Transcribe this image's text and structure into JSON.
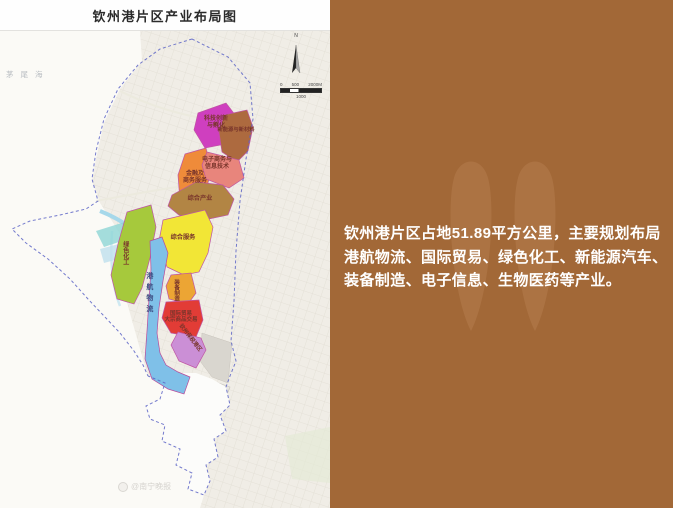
{
  "window": {
    "title": "钦州港片区产业布局图"
  },
  "colors": {
    "panel-bg": "#a26837",
    "panel-text": "#ffffff",
    "panel-watermark": "#c08a5c",
    "map-label": "#79352b",
    "river-label": "#3d4e83",
    "boundary-dash": "#5b63c5"
  },
  "map": {
    "sea_label": "茅尾海",
    "compass_label": "N",
    "scale": {
      "start": "0",
      "mid_top": "500",
      "end": "2000M",
      "mid_bottom": "1000"
    },
    "zones": [
      {
        "name": "科技创新与孵化",
        "color": "#cf3fbf",
        "label_lines": [
          "科技创新",
          "与孵化"
        ]
      },
      {
        "name": "新能源与新材料",
        "color": "#ad6a3f"
      },
      {
        "name": "金融及商务服务",
        "color": "#ef8b3a",
        "label_lines": [
          "金融及",
          "商务服务"
        ]
      },
      {
        "name": "电子商务与信息技术",
        "color": "#e8857c",
        "label_lines": [
          "电子商务与",
          "信息技术"
        ]
      },
      {
        "name": "综合产业",
        "color": "#b28544"
      },
      {
        "name": "综合服务",
        "color": "#f2e636"
      },
      {
        "name": "绿色化工",
        "color": "#a6c93c"
      },
      {
        "name": "港航物流",
        "color": "#7fc0e8"
      },
      {
        "name": "装备制造",
        "color": "#eca534"
      },
      {
        "name": "国际贸易 大宗商品交易",
        "color": "#e23c36",
        "label_lines": [
          "国际贸易",
          "大宗商品交易"
        ]
      },
      {
        "name": "钦州保税港区",
        "color": "#cb8fd6"
      }
    ],
    "watermark": "@南宁晚报"
  },
  "panel": {
    "lines": [
      "钦州港片区占地51.89平方公里，主要规划布局",
      "港航物流、国际贸易、绿色化工、新能源汽车、",
      "装备制造、电子信息、生物医药等产业。"
    ]
  }
}
